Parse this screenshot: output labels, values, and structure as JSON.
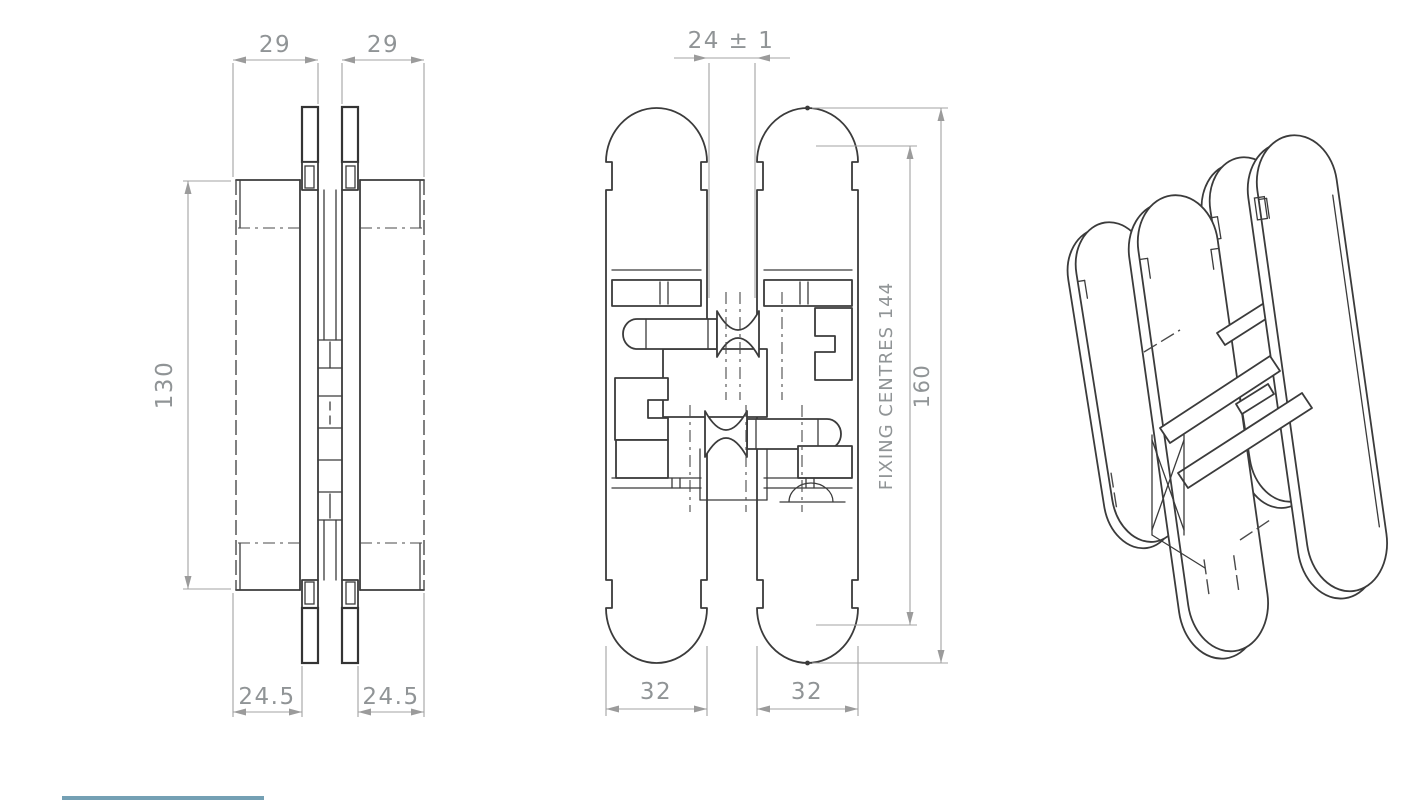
{
  "drawing": {
    "subject": "concealed hinge technical drawing, three views",
    "colors": {
      "part_line": "#3b3b3b",
      "dimension_line": "#a3a3a3",
      "dimension_text": "#909496",
      "accent_edge": "#74a0b4",
      "background": "#ffffff"
    }
  },
  "dims": {
    "side_top_left": "29",
    "side_top_right": "29",
    "side_height": "130",
    "side_bottom_left": "24.5",
    "side_bottom_right": "24.5",
    "front_top_gap": "24 ± 1",
    "front_fixing_centres": "FIXING CENTRES 144",
    "front_overall_height": "160",
    "front_bottom_left": "32",
    "front_bottom_right": "32"
  }
}
